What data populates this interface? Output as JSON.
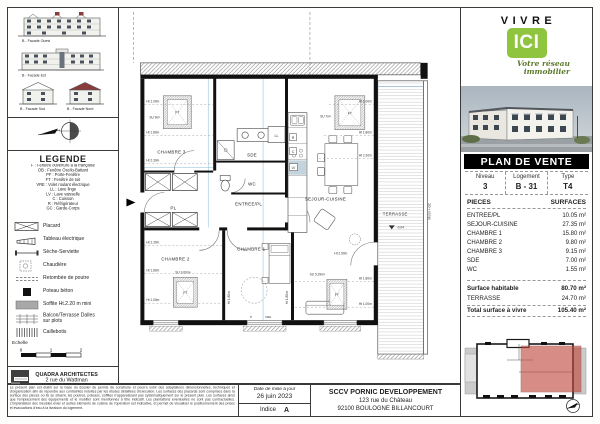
{
  "brand": {
    "vivre": "VIVRE",
    "ici": "ICI",
    "tagline1": "Votre réseau",
    "tagline2": "immobilier",
    "green": "#8fc43e",
    "tagline_color": "#5d7a2c"
  },
  "plan_de_vente": {
    "title": "PLAN DE VENTE",
    "meta": [
      {
        "header": "Niveau",
        "value": "3"
      },
      {
        "header": "Logement",
        "value": "B - 31"
      },
      {
        "header": "Type",
        "value": "T4"
      }
    ],
    "pieces_header": "PIECES",
    "surfaces_header": "SURFACES",
    "rooms": [
      {
        "label": "ENTREE/PL",
        "surface": "10.05 m²"
      },
      {
        "label": "SEJOUR-CUISINE",
        "surface": "27.35 m²"
      },
      {
        "label": "CHAMBRE 1",
        "surface": "15.80 m²"
      },
      {
        "label": "CHAMBRE 2",
        "surface": "9.80 m²"
      },
      {
        "label": "CHAMBRE 3",
        "surface": "9.15 m²"
      },
      {
        "label": "SDE",
        "surface": "7.00 m²"
      },
      {
        "label": "WC",
        "surface": "1.55 m²"
      }
    ],
    "summary": [
      {
        "label": "Surface habitable",
        "value": "80.70 m²"
      },
      {
        "label": "TERRASSE",
        "value": "24.70 m²"
      },
      {
        "label": "Total surface à vivre",
        "value": "105.40 m²"
      }
    ]
  },
  "facades": {
    "items": [
      {
        "label": "B - Facade Ouest"
      },
      {
        "label": "B - Facade Est"
      },
      {
        "label": "B - Facade Sud"
      },
      {
        "label": "B - Facade Nord"
      }
    ]
  },
  "legende": {
    "title": "LEGENDE",
    "abbreviations": [
      "F : Fenêtre ouverture à la française",
      "OB : Fenêtre Oscilo-Battant",
      "PF : Porte-Fenêtre",
      "FT : Fenêtre de toit",
      "VRE : Volet roulant électrique",
      "LL : Lave linge",
      "LV : Lave vaisselle",
      "C : Cuisson",
      "R : Réfrigérateur",
      "GC : Garde-Corps"
    ],
    "symbols": [
      {
        "label": "Placard"
      },
      {
        "label": "Tableau électrique"
      },
      {
        "label": "Sèche-Serviette"
      },
      {
        "label": "Chaudière"
      },
      {
        "label": "Retombée de poutre"
      },
      {
        "label": "Poteau béton"
      },
      {
        "label": "Soffite Ht.2.20 m mini"
      },
      {
        "label": "Balcon/Terrasse Dalles sur plots"
      },
      {
        "label": "Caillebotis"
      }
    ],
    "echelle_label": "Echelle",
    "scale_ticks": [
      "0",
      "1",
      "2"
    ]
  },
  "architect": {
    "name": "QUADRA ARCHITECTES",
    "address1": "2 rue du Wattman",
    "address2": "44700 ORVAULT"
  },
  "footer": {
    "disclaimer": "Le présent plan est établi sur la base du dossier de permis de construire et pourra subir des adaptations dimensionnelles, techniques et d'organisation afin de répondre aux contraintes induites par les études détaillées d'exécution. Les surfaces des placards sont comprises dans la surface des pièces où ils se situent, les poutres, poteaux, soffites n'apparaissant pas systématiquement sur le présent plan. Les surfaces ainsi que l'emplacement des équipements et le mobilier sont mentionnés à titre indicatif. Les plantations éventuelles ne sont pas contractuelles. L'implantation des meubles évier et autres éléments de cuisine de l'opération est indicative, et permet de visualiser le positionnement des prises et évacuations d'eau à la livraison du logement.",
    "date_label": "Date de mise à jour",
    "date_value": "26 juin 2023",
    "indice_label": "Indice",
    "indice_value": "A",
    "developer_name": "SCCV PORNIC DEVELOPPEMENT",
    "developer_address1": "123 rue du Château",
    "developer_address2": "92100 BOULOGNE BILLANCOURT"
  },
  "plan": {
    "rooms": {
      "chambre3": "CHAMBRE 3",
      "chambre2": "CHAMBRE 2",
      "chambre1": "CHAMBRE 1",
      "sde": "SDE",
      "wc": "WC",
      "entree": "ENTREE/PL",
      "pl": "PL",
      "sejour": "SEJOUR-CUISINE",
      "terrasse": "TERRASSE"
    },
    "annotations": {
      "ft": "FT",
      "ll": "LL",
      "lv": "LV",
      "c": "C",
      "r": "R",
      "p": "P",
      "vre": "VRE",
      "muret": "Muret + GC",
      "level": "-0.04",
      "ht100": "Ht 1.00m",
      "ht180": "Ht 1.80m",
      "ht230": "Ht 2.30m",
      "ht250": "Ht 2.50m",
      "su_ch3": "SU 9m²",
      "su_ch2": "SU 9.69m²",
      "su_sej_haut": "SU 7m²",
      "su_sej_bas": "SU 5.29m²"
    }
  },
  "colors": {
    "unit_red": "#c0463c",
    "roof_red": "#8a3c3c",
    "dim_blue": "#8ab9d6"
  }
}
